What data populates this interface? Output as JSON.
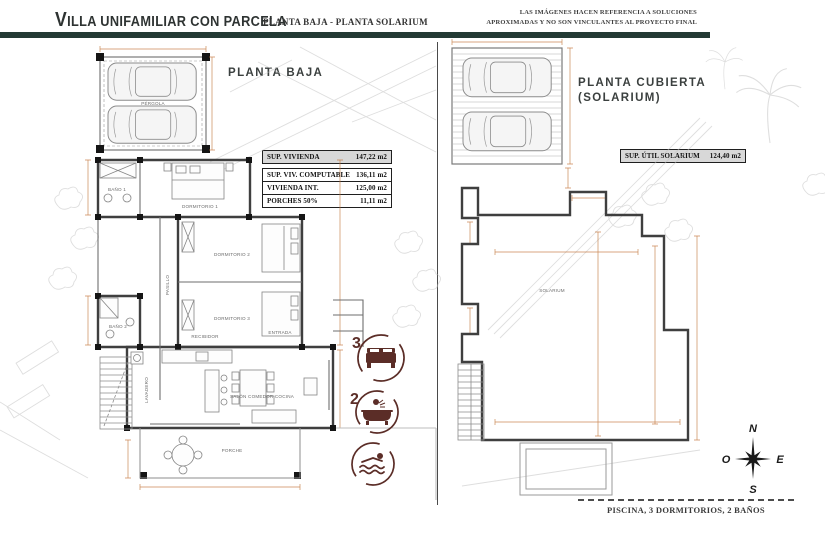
{
  "header": {
    "title": "Villa unifamiliar con parcela",
    "subtitle": "PLANTA BAJA - PLANTA SOLARIUM",
    "disclaimer_line1": "LAS IMÁGENES HACEN REFERENCIA A SOLUCIONES",
    "disclaimer_line2": "APROXIMADAS Y NO SON VINCULANTES AL PROYECTO FINAL"
  },
  "plans": {
    "left": {
      "title": "PLANTA BAJA",
      "table": {
        "rows": [
          {
            "label": "SUP. VIVIENDA",
            "value": "147,22 m2"
          },
          {
            "label": "SUP. VIV. COMPUTABLE",
            "value": "136,11 m2"
          },
          {
            "label": "VIVIENDA INT.",
            "value": "125,00 m2"
          },
          {
            "label": "PORCHES 50%",
            "value": "11,11 m2"
          }
        ]
      },
      "rooms": {
        "pergola": "PÉRGOLA",
        "bano1": "BAÑO 1",
        "dormitorio1": "DORMITORIO 1",
        "pasillo": "PASILLO",
        "dormitorio2": "DORMITORIO 2",
        "dormitorio3": "DORMITORIO 3",
        "bano2": "BAÑO 2",
        "recibidor": "RECIBIDOR",
        "entrada": "ENTRADA",
        "lavadero": "LAVADERO",
        "salon": "SALÓN COMEDOR COCINA",
        "porche": "PORCHE"
      }
    },
    "right": {
      "title_line1": "PLANTA CUBIERTA",
      "title_line2": "(SOLARIUM)",
      "table": {
        "rows": [
          {
            "label": "SUP. ÚTIL SOLARIUM",
            "value": "124,40 m2"
          }
        ]
      },
      "rooms": {
        "solarium": "SOLARIUM"
      }
    }
  },
  "features": {
    "bedrooms_count": "3",
    "bathrooms_count": "2"
  },
  "compass": {
    "north": "N",
    "east": "E",
    "south": "S",
    "west": "O"
  },
  "footer": {
    "summary": "PISCINA, 3 DORMITORIOS, 2 BAÑOS"
  },
  "colors": {
    "accent_bar": "#233a34",
    "feature_icon": "#5b2d27",
    "dimension_lines": "#c2763a"
  }
}
